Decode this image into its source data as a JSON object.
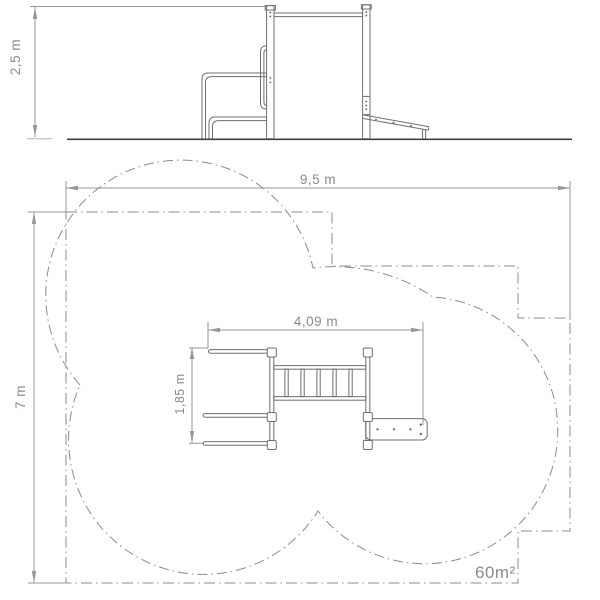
{
  "drawing": {
    "title": "playground-equipment-technical-drawing",
    "elevation": {
      "height_label": "2,5 m"
    },
    "plan": {
      "width_label": "9,5 m",
      "depth_label": "7 m",
      "equip_width_label": "4,09 m",
      "equip_depth_label": "1,85 m",
      "area_label": "60m²"
    },
    "colors": {
      "equipment_line": "#6f6f6f",
      "dimension_line": "#979797",
      "boundary_line": "#8c8c8c",
      "ground_line": "#3f3f3f",
      "text": "#8a8a8a",
      "background": "#ffffff"
    }
  }
}
